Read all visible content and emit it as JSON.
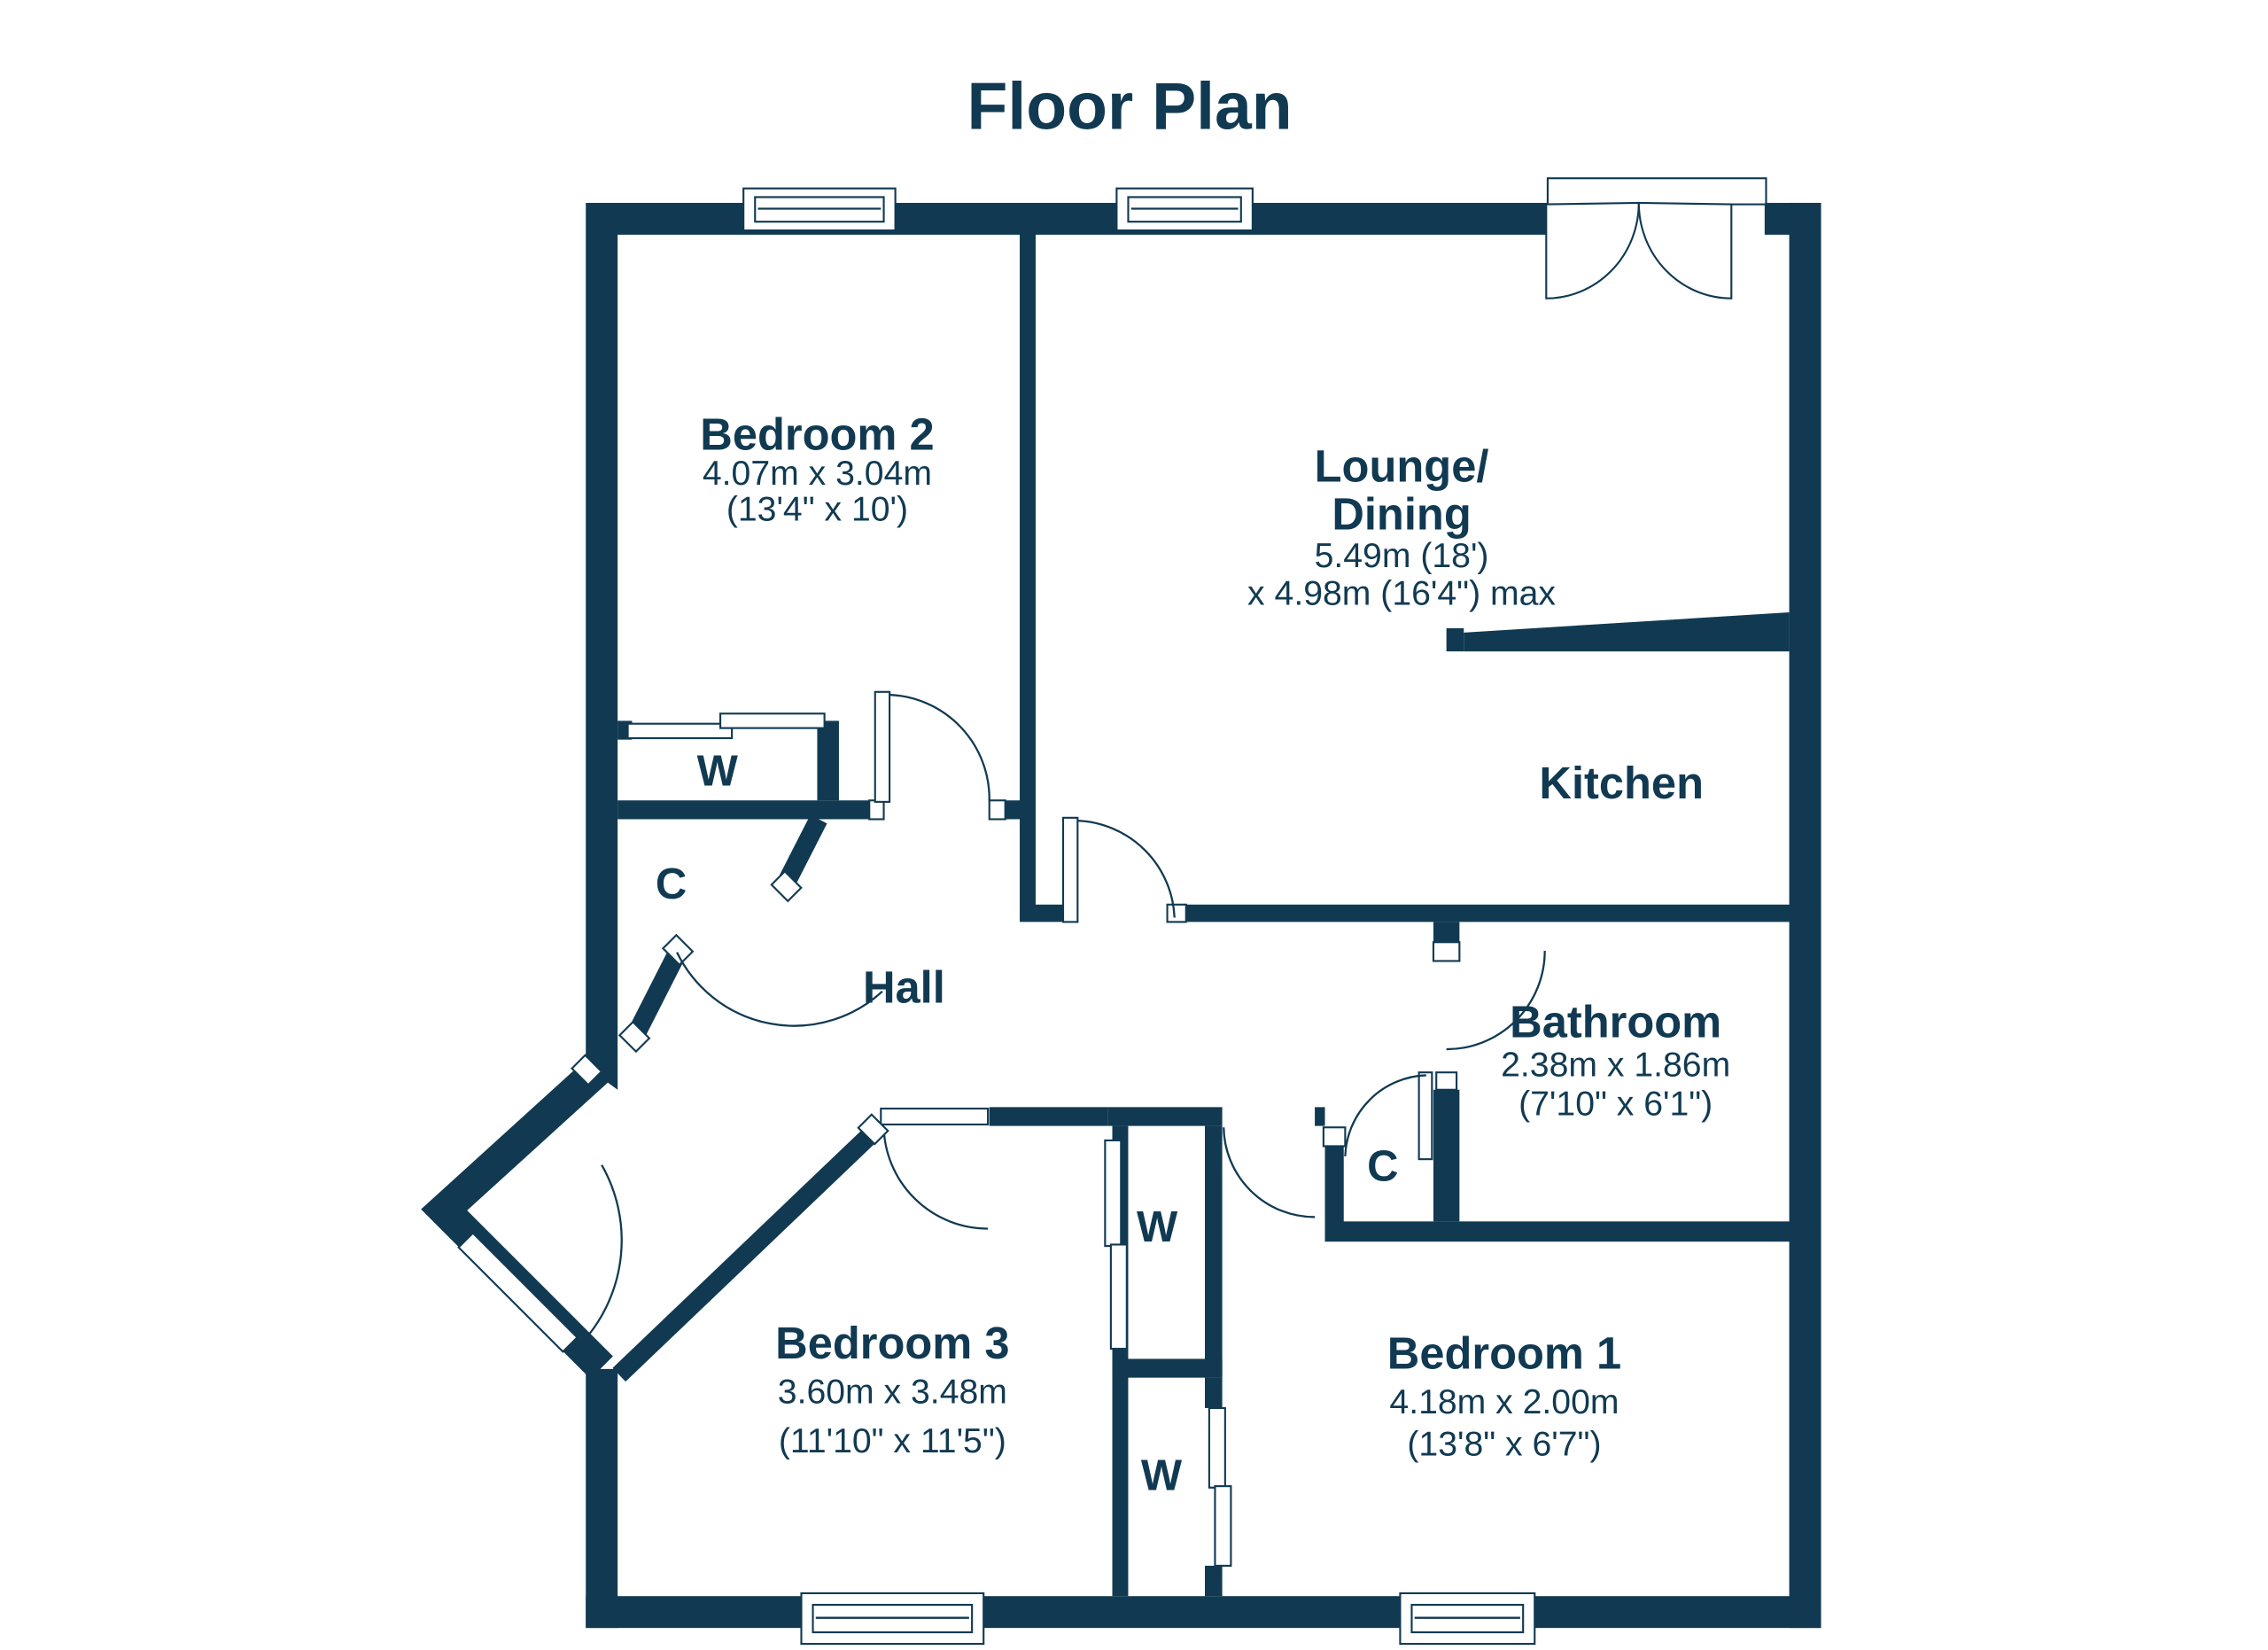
{
  "title": "Floor Plan",
  "colors": {
    "wall": "#113a52",
    "background": "#ffffff"
  },
  "rooms": {
    "bedroom2": {
      "name": "Bedroom 2",
      "dims_metric": "4.07m x 3.04m",
      "dims_imperial": "(13'4\" x 10')"
    },
    "lounge": {
      "name_line1": "Lounge/",
      "name_line2": "Dining",
      "dims_metric": "5.49m (18')",
      "dims_imperial": "x 4.98m (16'4\") max"
    },
    "kitchen": {
      "name": "Kitchen"
    },
    "hall": {
      "name": "Hall"
    },
    "bathroom": {
      "name": "Bathroom",
      "dims_metric": "2.38m x 1.86m",
      "dims_imperial": "(7'10\" x 6'1\")"
    },
    "bedroom3": {
      "name": "Bedroom 3",
      "dims_metric": "3.60m x 3.48m",
      "dims_imperial": "(11'10\" x 11'5\")"
    },
    "bedroom1": {
      "name": "Bedroom 1",
      "dims_metric": "4.18m x 2.00m",
      "dims_imperial": "(13'8\" x 6'7\")"
    }
  },
  "closets": {
    "wardrobe_label": "W",
    "cupboard_label": "C"
  }
}
